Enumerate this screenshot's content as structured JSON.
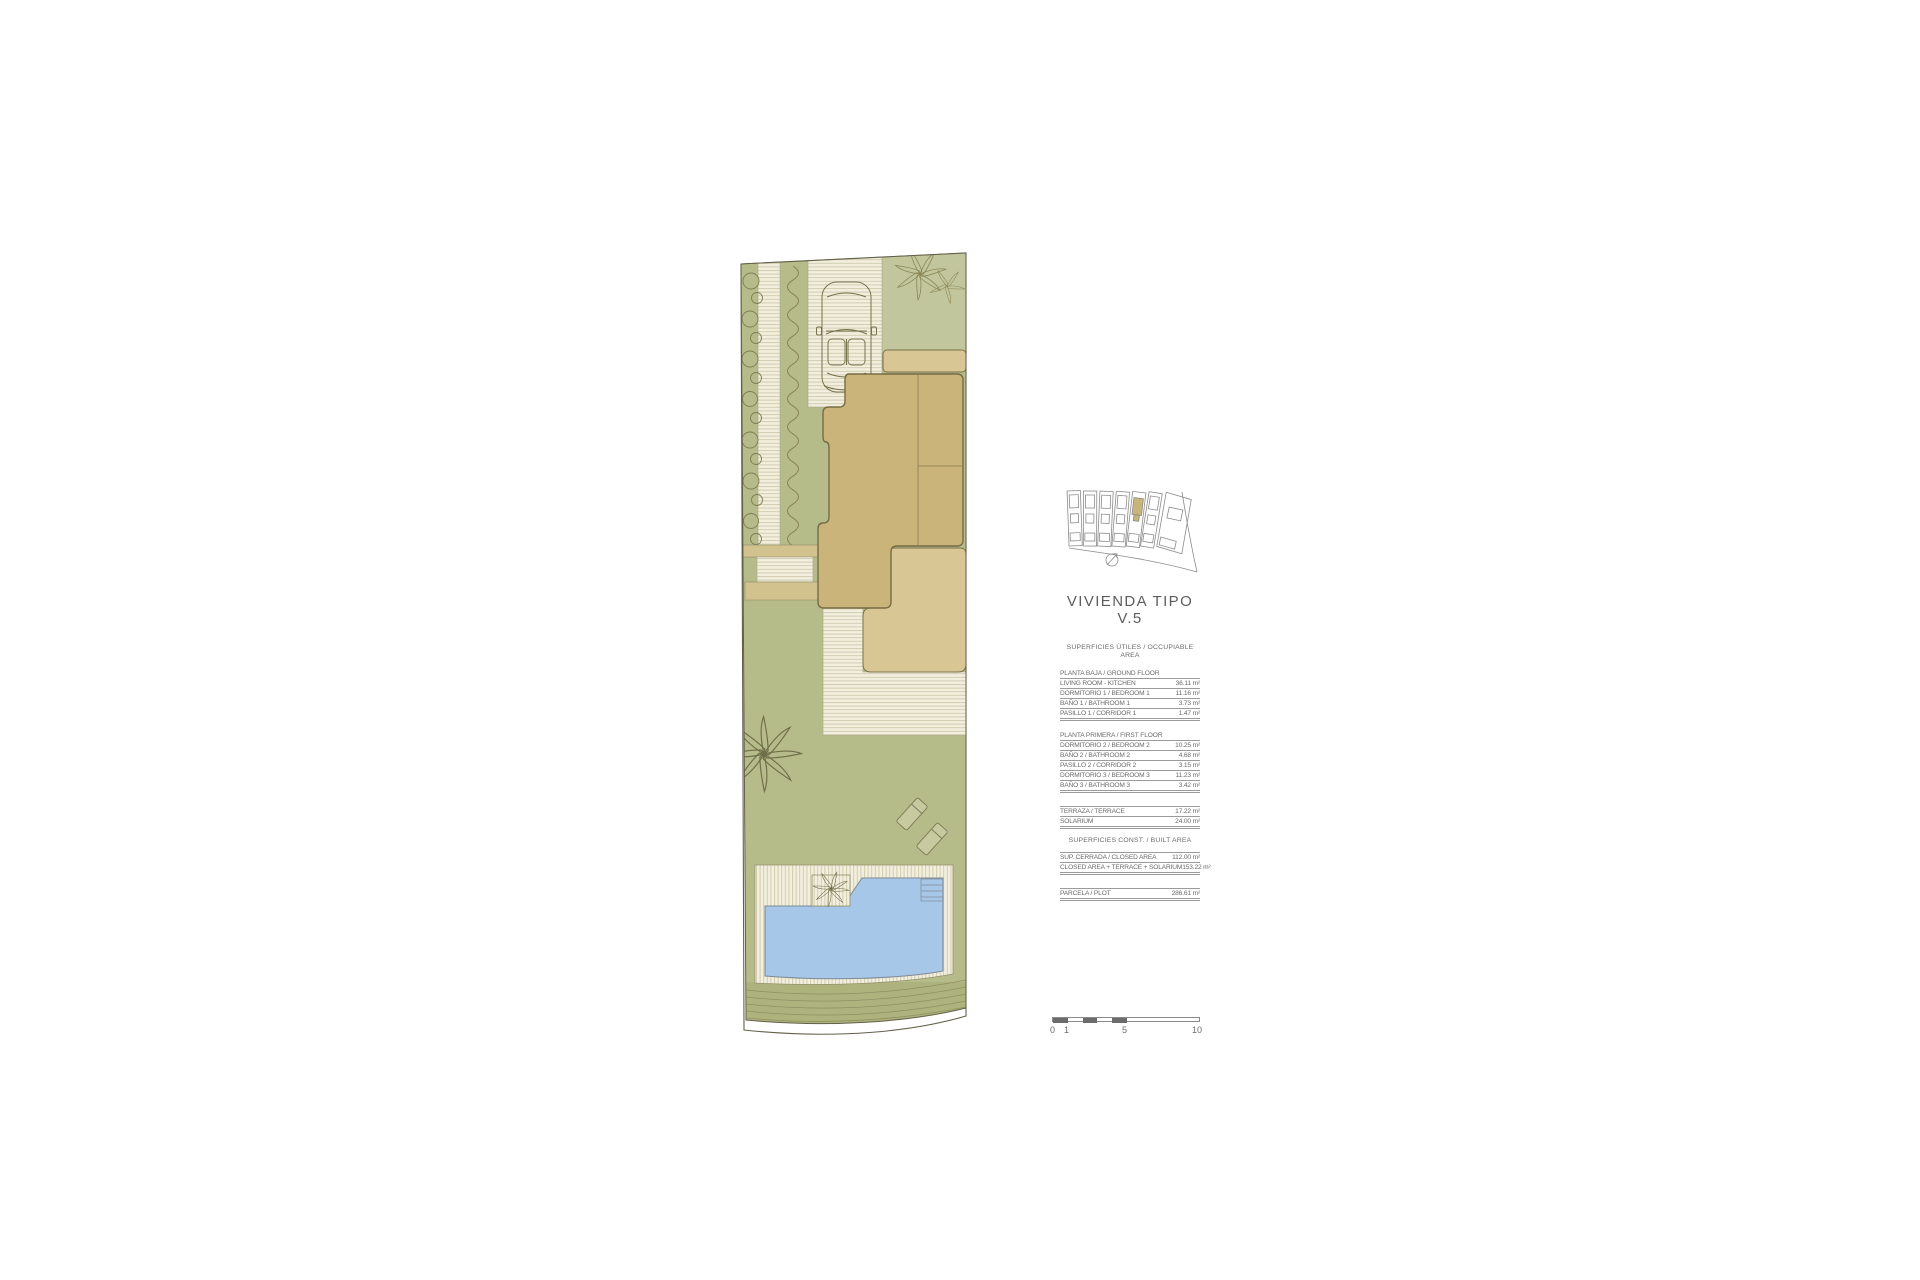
{
  "title": {
    "line1": "VIVIENDA TIPO",
    "line2": "V.5"
  },
  "areas_table": {
    "occupiable_header": "SUPERFICIES ÚTILES / OCCUPIABLE AREA",
    "built_header": "SUPERFICIES  CONST. / BUILT AREA",
    "groups": [
      {
        "header": "PLANTA BAJA / GROUND FLOOR",
        "rows": [
          {
            "label": "LIVING ROOM - KITCHEN",
            "value": "36.11 m²"
          },
          {
            "label": "DORMITORIO 1 /  BEDROOM 1",
            "value": "11.16 m²"
          },
          {
            "label": "BAÑO 1 / BATHROOM 1",
            "value": "3.73 m²"
          },
          {
            "label": "PASILLO 1 / CORRIDOR 1",
            "value": "1.47 m²"
          }
        ]
      },
      {
        "header": "PLANTA PRIMERA / FIRST FLOOR",
        "rows": [
          {
            "label": "DORMITORIO 2 / BEDROOM 2",
            "value": "10.25 m²"
          },
          {
            "label": "BAÑO 2 / BATHROOM 2",
            "value": "4.68 m²"
          },
          {
            "label": "PASILLO 2 / CORRIDOR 2",
            "value": "3.15 m²"
          },
          {
            "label": "DORMITORIO 3 / BEDROOM 3",
            "value": "11.23 m²"
          },
          {
            "label": "BAÑO 3 / BATHROOM 3",
            "value": "3.42 m²"
          }
        ]
      },
      {
        "header": "",
        "rows": [
          {
            "label": "TERRAZA / TERRACE",
            "value": "17.22 m²"
          },
          {
            "label": "SOLARIUM",
            "value": "24.00 m²"
          }
        ]
      },
      {
        "header": "",
        "rows": [
          {
            "label": "SUP. CERRADA / CLOSED AREA",
            "value": "112.00 m²"
          },
          {
            "label": "CLOSED AREA + TERRACE + SOLARIUM",
            "value": "153.22 m²"
          }
        ]
      },
      {
        "header": "",
        "rows": [
          {
            "label": "PARCELA / PLOT",
            "value": "286.61 m²"
          }
        ]
      }
    ]
  },
  "scale_bar": {
    "labels": [
      "0",
      "1",
      "5",
      "10"
    ]
  },
  "site_plan": {
    "elements": [
      "plot-boundary",
      "bush-row",
      "side-walkway",
      "hedge-row",
      "driveway",
      "car",
      "shrub",
      "entry-porch",
      "house-footprint",
      "side-steps",
      "terrace",
      "patio-paving",
      "garden-lawn",
      "palm-tree",
      "sun-loungers",
      "pool-deck",
      "pool",
      "pool-steps",
      "pool-planter",
      "hedge-band"
    ],
    "highlighted_unit": "V.5"
  },
  "colors": {
    "garden_green": "#b6bb8a",
    "light_green": "#c2c69c",
    "house_tan": "#cab47a",
    "terrace_tan": "#d8c795",
    "pool_blue": "#a7c7e9",
    "paving_cream": "#f3efdf",
    "outline": "#63604a",
    "text_gray": "#6a6a6a",
    "map_highlight": "#c9b47a"
  }
}
